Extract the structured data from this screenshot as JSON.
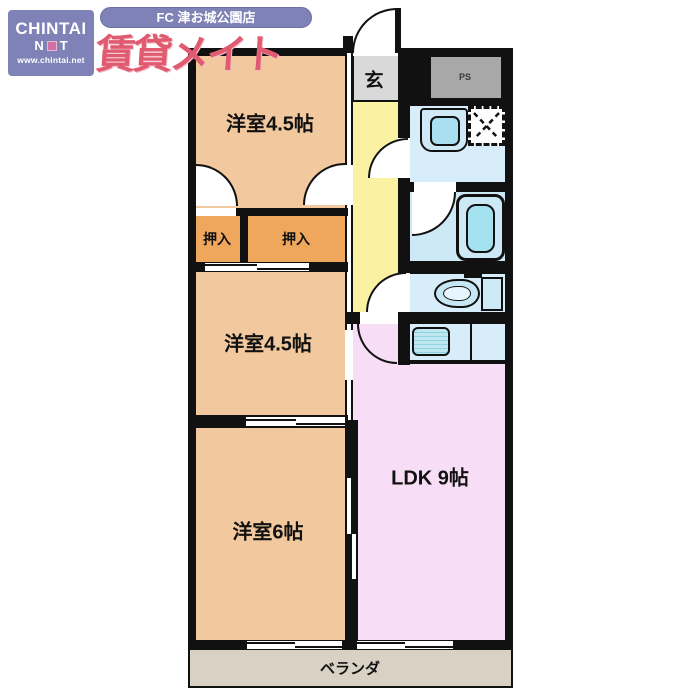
{
  "branding": {
    "chintai_logo": {
      "line1": "CHINTAI",
      "net_left": "N",
      "net_right": "T",
      "url": "www.chintai.net"
    },
    "store_banner": "FC 津お城公園店",
    "brand_name": "賃貸メイト"
  },
  "floorplan": {
    "bedroom_top": "洋室4.5帖",
    "bedroom_middle": "洋室4.5帖",
    "bedroom_bottom": "洋室6帖",
    "ldk": "LDK 9帖",
    "closet_left": "押入",
    "closet_right": "押入",
    "entrance": "玄",
    "pipe_space": "PS",
    "veranda": "ベランダ"
  },
  "colors": {
    "accent_periwinkle": "#7f82b7",
    "brand_red": "#e05a70",
    "room_peach": "#f2c89e",
    "closet_orange": "#efa75e",
    "hall_yellow": "#faf2a2",
    "entrance_gray": "#d9d9d9",
    "pipe_space_gray": "#a8a8a8",
    "wet_area_blue": "#d7edf9",
    "bath_fill": "#a5e2ef",
    "ldk_pink": "#f7def6",
    "veranda_beige": "#d9d2c4",
    "wall_black": "#111111"
  }
}
